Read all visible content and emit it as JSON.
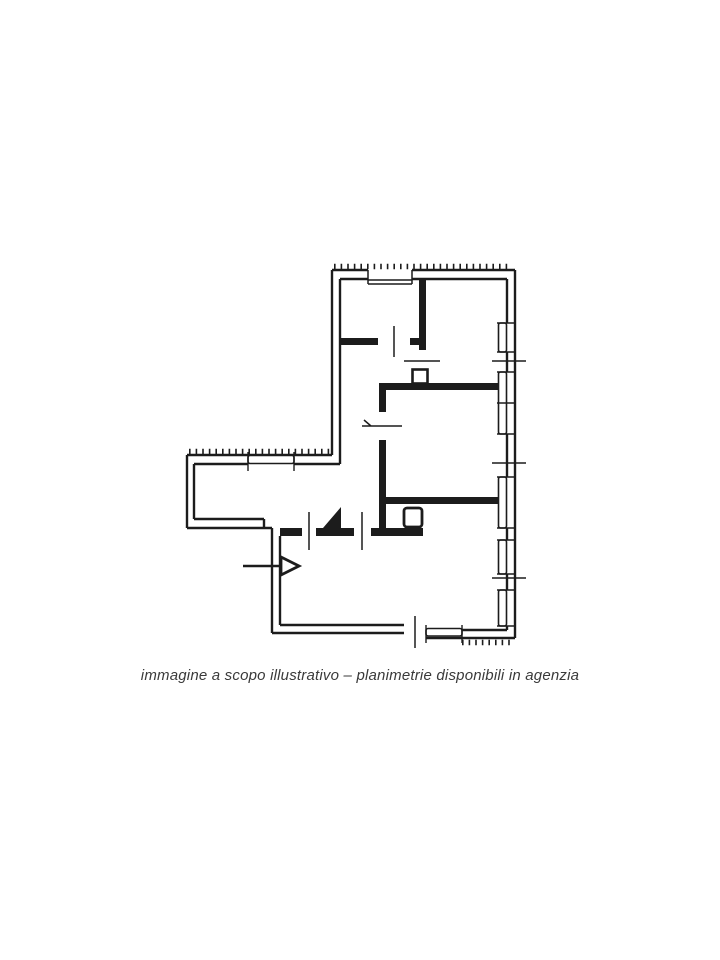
{
  "window": {
    "width_px": 720,
    "height_px": 960,
    "background": "#ffffff"
  },
  "floor_plan": {
    "kind": "architectural-floor-plan",
    "ink_color": "#1c1c1c",
    "paper_color": "#ffffff"
  },
  "caption": {
    "text": "immagine a scopo illustrativo – planimetrie disponibili in agenzia",
    "color": "#3a3a3a"
  }
}
